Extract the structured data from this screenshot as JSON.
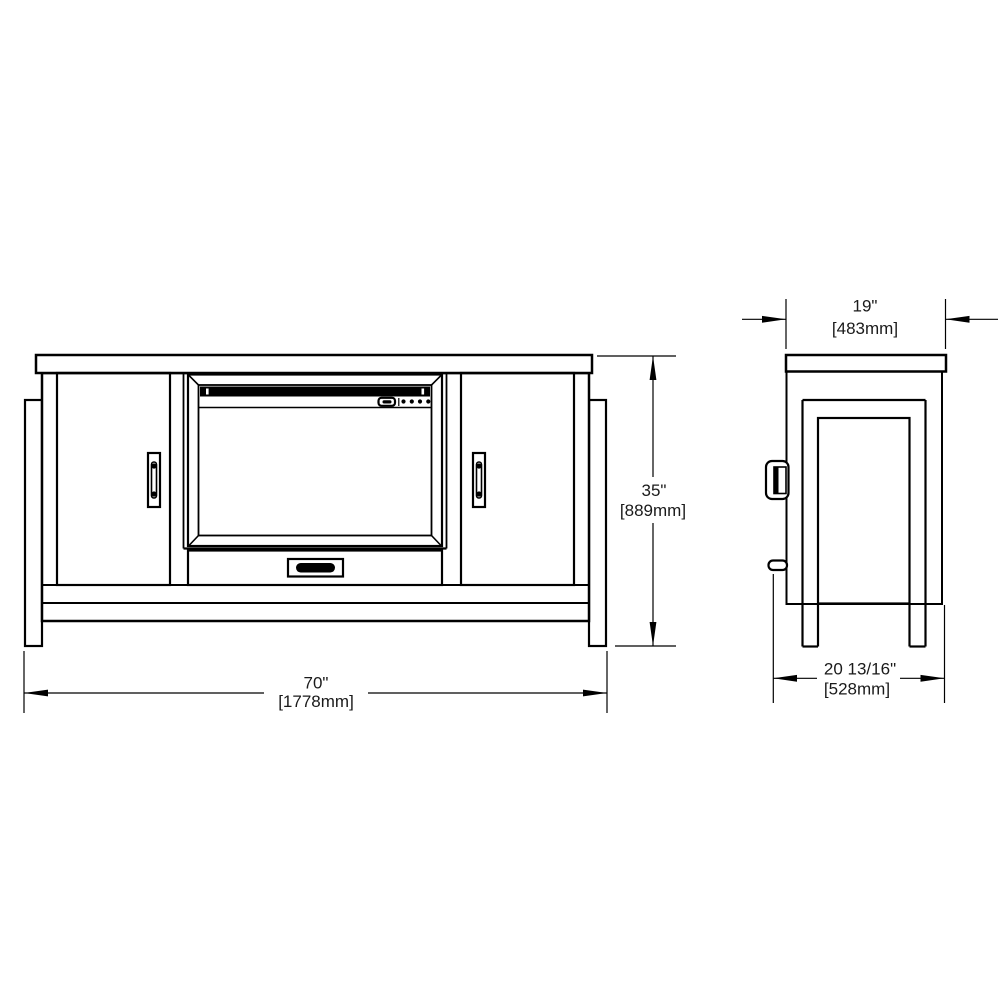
{
  "drawing": {
    "background": "#ffffff",
    "line_color": "#000000",
    "text_color": "#1a1a1a",
    "dimensions": {
      "width": {
        "inches": "70\"",
        "mm": "[1778mm]"
      },
      "height": {
        "inches": "35\"",
        "mm": "[889mm]"
      },
      "depth": {
        "inches": "19\"",
        "mm": "[483mm]"
      },
      "overall_depth": {
        "inches": "20 13/16\"",
        "mm": "[528mm]"
      }
    }
  }
}
